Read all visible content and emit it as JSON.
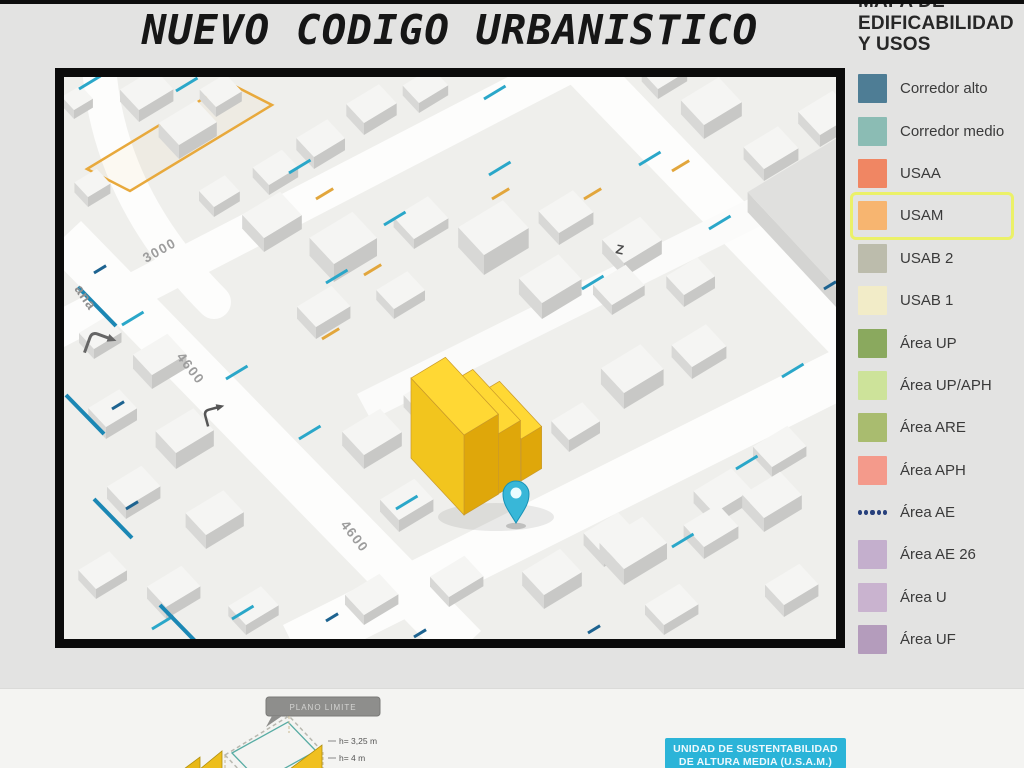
{
  "page": {
    "title": "NUEVO CODIGO URBANISTICO"
  },
  "legend": {
    "title_lines": [
      "MAPA DE",
      "EDIFICABILIDAD",
      "Y USOS"
    ],
    "items": [
      {
        "label": "Corredor alto",
        "color": "#4e7d95",
        "type": "swatch"
      },
      {
        "label": "Corredor medio",
        "color": "#8bbcb4",
        "type": "swatch"
      },
      {
        "label": "USAA",
        "color": "#f08663",
        "type": "swatch"
      },
      {
        "label": "USAM",
        "color": "#f7b570",
        "type": "swatch",
        "highlighted": true,
        "highlight_color": "#ebf168"
      },
      {
        "label": "USAB 2",
        "color": "#bcbcac",
        "type": "swatch"
      },
      {
        "label": "USAB 1",
        "color": "#f2ecc8",
        "type": "swatch"
      },
      {
        "label": "Área UP",
        "color": "#8aa95e",
        "type": "swatch"
      },
      {
        "label": "Área UP/APH",
        "color": "#cde39a",
        "type": "swatch"
      },
      {
        "label": "Área ARE",
        "color": "#a9bc6f",
        "type": "swatch"
      },
      {
        "label": "Área APH",
        "color": "#f49a8b",
        "type": "swatch"
      },
      {
        "label": "Área AE",
        "color": "#27407c",
        "type": "dots"
      },
      {
        "label": "Área AE 26",
        "color": "#c4afcd",
        "type": "swatch"
      },
      {
        "label": "Área U",
        "color": "#c9b3cf",
        "type": "swatch"
      },
      {
        "label": "Área UF",
        "color": "#b49cbc",
        "type": "swatch"
      }
    ]
  },
  "map": {
    "street_labels": [
      {
        "text": "3000"
      },
      {
        "text": "4600"
      },
      {
        "text": "4600"
      },
      {
        "text": "ana"
      },
      {
        "text": "Z"
      }
    ],
    "marker": {
      "type": "location-pin",
      "color": "#38b7d8"
    },
    "highlight_building_color": "#f2c51e"
  },
  "footer": {
    "diagram": {
      "tag_label": "PLANO LIMITE",
      "height_labels": [
        "h= 3,25 m",
        "h= 4 m"
      ]
    },
    "usam_box": {
      "lines": [
        "UNIDAD DE SUSTENTABILIDAD",
        "DE ALTURA MEDIA (U.S.A.M.)"
      ],
      "color": "#2bb4d8"
    }
  }
}
